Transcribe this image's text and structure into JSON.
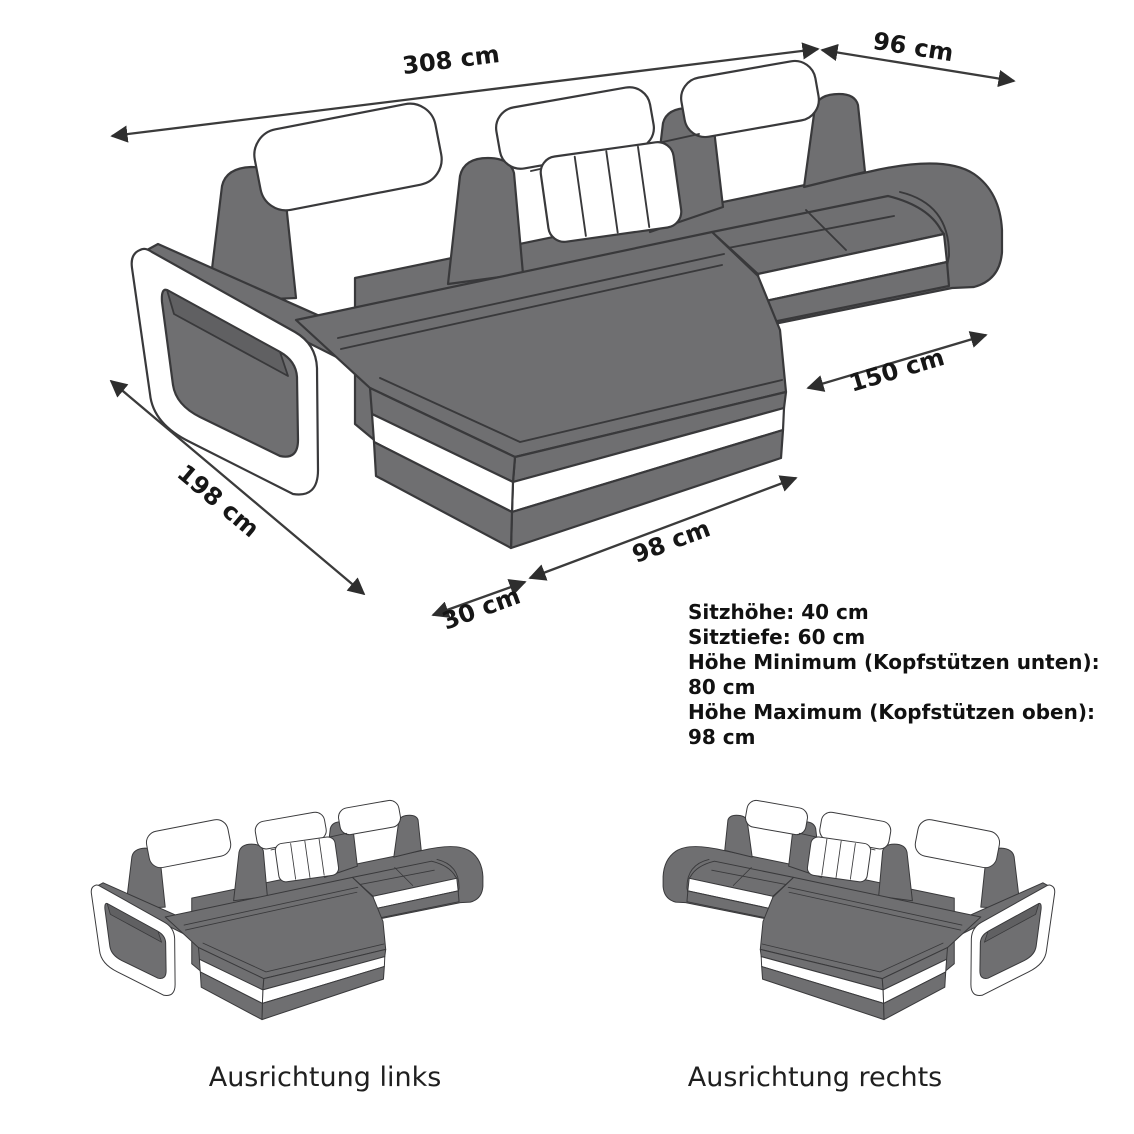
{
  "diagram": {
    "title_hint": "sofa-dimension-diagram",
    "dimensions": {
      "total_width": "308 cm",
      "total_depth": "96 cm",
      "seat_front_right": "150 cm",
      "chaise_length": "198 cm",
      "chaise_front": "98 cm",
      "arm_front": "30 cm"
    },
    "specs": [
      "Sitzhöhe: 40 cm",
      "Sitztiefe: 60 cm",
      "Höhe Minimum (Kopfstützen unten): 80 cm",
      "Höhe Maximum (Kopfstützen oben): 98 cm"
    ],
    "variants": [
      {
        "caption": "Ausrichtung links"
      },
      {
        "caption": "Ausrichtung rechts"
      }
    ],
    "colors": {
      "sofa_gray": "#6f6f71",
      "outline": "#39393b",
      "accent_white": "#ffffff",
      "dimension_line": "#3b3b3b",
      "text": "#161616",
      "background": "#ffffff"
    }
  }
}
